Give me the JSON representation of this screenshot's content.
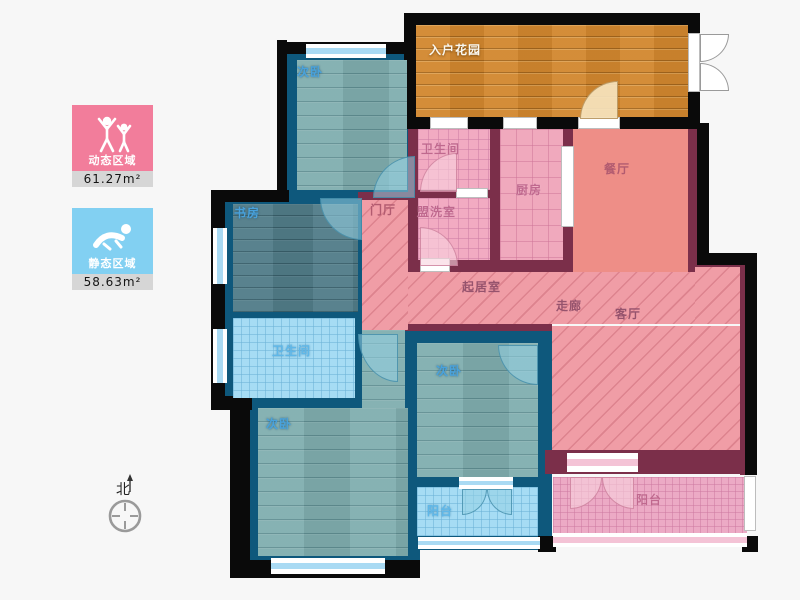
{
  "legend": {
    "dynamic": {
      "label": "动态区域",
      "value": "61.27m²",
      "color": "#f27d9b",
      "icon": "dancing-people-icon"
    },
    "static": {
      "label": "静态区域",
      "value": "58.63m²",
      "color": "#82d0f2",
      "icon": "sleeping-person-icon"
    }
  },
  "compass": {
    "label": "北"
  },
  "floorplan": {
    "palette": {
      "black": "#0a0a0a",
      "navy": "#0e587c",
      "maroon": "#7b2f4a",
      "accent_pink": "#f27d9b",
      "accent_blue": "#82d0f2"
    },
    "blocks": [
      {
        "n": "wall-bedroom-tl-block",
        "x": 279,
        "y": 44,
        "w": 139,
        "h": 156,
        "c": "navy"
      },
      {
        "n": "wall-study-band-block",
        "x": 213,
        "y": 192,
        "w": 205,
        "h": 216,
        "c": "navy"
      },
      {
        "n": "wall-bedroom-bl-block",
        "x": 248,
        "y": 398,
        "w": 172,
        "h": 178,
        "c": "navy"
      },
      {
        "n": "wall-bedroom-mid-maroon-edge",
        "x": 405,
        "y": 324,
        "w": 147,
        "h": 10,
        "c": "maroon"
      },
      {
        "n": "wall-bedroom-mid-block",
        "x": 405,
        "y": 331,
        "w": 147,
        "h": 219,
        "c": "navy"
      },
      {
        "n": "wall-pink-top-block",
        "x": 408,
        "y": 118,
        "w": 292,
        "h": 156,
        "c": "maroon"
      },
      {
        "n": "wall-foyer-top-edge",
        "x": 358,
        "y": 192,
        "w": 52,
        "h": 8,
        "c": "maroon"
      },
      {
        "n": "wall-living-bottom",
        "x": 545,
        "y": 450,
        "w": 212,
        "h": 24,
        "c": "maroon"
      },
      {
        "n": "wall-dining-right-maroon",
        "x": 688,
        "y": 125,
        "w": 9,
        "h": 139,
        "c": "maroon"
      },
      {
        "n": "wall-right-maroon",
        "x": 740,
        "y": 253,
        "w": 17,
        "h": 222,
        "c": "maroon"
      },
      {
        "n": "wall-right-step-maroon",
        "x": 695,
        "y": 260,
        "w": 62,
        "h": 10,
        "c": "maroon"
      },
      {
        "n": "wall-garden-block",
        "x": 404,
        "y": 13,
        "w": 296,
        "h": 116,
        "c": "black"
      },
      {
        "n": "wall-bedroom-tl-left-black",
        "x": 277,
        "y": 40,
        "w": 10,
        "h": 162,
        "c": "black"
      },
      {
        "n": "wall-bedroom-tl-top-black",
        "x": 277,
        "y": 42,
        "w": 141,
        "h": 12,
        "c": "black"
      },
      {
        "n": "wall-study-step-black",
        "x": 211,
        "y": 190,
        "w": 78,
        "h": 12,
        "c": "black"
      },
      {
        "n": "wall-left-black",
        "x": 211,
        "y": 190,
        "w": 14,
        "h": 216,
        "c": "black"
      },
      {
        "n": "wall-bl-step-black",
        "x": 211,
        "y": 396,
        "w": 41,
        "h": 14,
        "c": "black"
      },
      {
        "n": "wall-bedroom-bl-left-black",
        "x": 230,
        "y": 396,
        "w": 20,
        "h": 182,
        "c": "black"
      },
      {
        "n": "wall-bedroom-bl-bottom-black",
        "x": 230,
        "y": 560,
        "w": 190,
        "h": 18,
        "c": "black"
      },
      {
        "n": "wall-balcony-blue-corner-black",
        "x": 538,
        "y": 536,
        "w": 18,
        "h": 16,
        "c": "black"
      },
      {
        "n": "wall-dining-right-black",
        "x": 697,
        "y": 123,
        "w": 12,
        "h": 141,
        "c": "black"
      },
      {
        "n": "wall-right-step-black",
        "x": 697,
        "y": 253,
        "w": 60,
        "h": 12,
        "c": "black"
      },
      {
        "n": "wall-right-black",
        "x": 745,
        "y": 253,
        "w": 12,
        "h": 222,
        "c": "black"
      },
      {
        "n": "wall-balcony-pink-corner-black",
        "x": 742,
        "y": 536,
        "w": 16,
        "h": 16,
        "c": "black"
      }
    ],
    "floors": [
      {
        "n": "floor-bedroom-tl",
        "x": 297,
        "y": 60,
        "w": 110,
        "h": 130,
        "p": "teal"
      },
      {
        "n": "floor-study",
        "x": 233,
        "y": 204,
        "w": 125,
        "h": 108,
        "p": "tealdark"
      },
      {
        "n": "floor-bath-left",
        "x": 233,
        "y": 318,
        "w": 122,
        "h": 80,
        "p": "bluetile"
      },
      {
        "n": "floor-corridor",
        "x": 362,
        "y": 330,
        "w": 43,
        "h": 78,
        "p": "teal"
      },
      {
        "n": "floor-bedroom-bl",
        "x": 258,
        "y": 408,
        "w": 150,
        "h": 148,
        "p": "teal"
      },
      {
        "n": "floor-bedroom-mid",
        "x": 417,
        "y": 343,
        "w": 121,
        "h": 134,
        "p": "teal"
      },
      {
        "n": "floor-balcony-blue",
        "x": 417,
        "y": 487,
        "w": 121,
        "h": 49,
        "p": "bluetile"
      },
      {
        "n": "floor-garden",
        "x": 416,
        "y": 25,
        "w": 272,
        "h": 92,
        "p": "orange"
      },
      {
        "n": "floor-bath-top",
        "x": 418,
        "y": 129,
        "w": 72,
        "h": 61,
        "p": "cross"
      },
      {
        "n": "floor-laundry",
        "x": 418,
        "y": 198,
        "w": 72,
        "h": 62,
        "p": "cross"
      },
      {
        "n": "floor-kitchen",
        "x": 500,
        "y": 129,
        "w": 63,
        "h": 131,
        "p": "grid"
      },
      {
        "n": "floor-dining",
        "x": 573,
        "y": 129,
        "w": 115,
        "h": 143,
        "p": "salmon"
      },
      {
        "n": "floor-foyer",
        "x": 362,
        "y": 200,
        "w": 46,
        "h": 130,
        "p": "diag"
      },
      {
        "n": "floor-hall-band",
        "x": 408,
        "y": 272,
        "w": 287,
        "h": 52,
        "p": "diag"
      },
      {
        "n": "floor-hall-right-ext",
        "x": 695,
        "y": 267,
        "w": 45,
        "h": 57,
        "p": "diag"
      },
      {
        "n": "floor-living-main",
        "x": 552,
        "y": 326,
        "w": 188,
        "h": 124,
        "p": "diag"
      },
      {
        "n": "floor-balcony-pink",
        "x": 553,
        "y": 477,
        "w": 194,
        "h": 56,
        "p": "pinktile"
      }
    ],
    "windows": [
      {
        "n": "window-bedroom-tl-top",
        "x": 306,
        "y": 44,
        "w": 80,
        "h": 14,
        "t": "blue"
      },
      {
        "n": "window-study-left",
        "x": 213,
        "y": 228,
        "w": 14,
        "h": 56,
        "t": "blue"
      },
      {
        "n": "window-bath-left",
        "x": 213,
        "y": 329,
        "w": 14,
        "h": 54,
        "t": "blue"
      },
      {
        "n": "window-bedroom-bl-bottom",
        "x": 271,
        "y": 558,
        "w": 114,
        "h": 16,
        "t": "blue"
      },
      {
        "n": "window-balcony-blue-bottom",
        "x": 418,
        "y": 537,
        "w": 122,
        "h": 12,
        "t": "blue"
      },
      {
        "n": "window-bedroom-mid-sill",
        "x": 459,
        "y": 477,
        "w": 54,
        "h": 12,
        "t": "blue"
      },
      {
        "n": "window-garden-bath",
        "x": 430,
        "y": 117,
        "w": 38,
        "h": 12,
        "t": "plain"
      },
      {
        "n": "window-garden-kitchen",
        "x": 503,
        "y": 117,
        "w": 34,
        "h": 12,
        "t": "plain"
      },
      {
        "n": "door-gap-garden",
        "x": 578,
        "y": 117,
        "w": 42,
        "h": 12,
        "t": "plain"
      },
      {
        "n": "door-gap-garden-entry",
        "x": 688,
        "y": 33,
        "w": 12,
        "h": 59,
        "t": "plain"
      },
      {
        "n": "door-sliding-kitchen",
        "x": 561,
        "y": 146,
        "w": 13,
        "h": 81,
        "t": "plain"
      },
      {
        "n": "door-gap-bath-top",
        "x": 456,
        "y": 188,
        "w": 32,
        "h": 10,
        "t": "plain"
      },
      {
        "n": "door-gap-laundry",
        "x": 420,
        "y": 258,
        "w": 30,
        "h": 14,
        "t": "plain"
      },
      {
        "n": "window-balcony-pink-right",
        "x": 744,
        "y": 476,
        "w": 12,
        "h": 55,
        "t": "plain"
      },
      {
        "n": "window-balcony-pink-bottom",
        "x": 553,
        "y": 533,
        "w": 194,
        "h": 14,
        "t": "pink"
      },
      {
        "n": "door-sill-living-balcony",
        "x": 567,
        "y": 453,
        "w": 71,
        "h": 19,
        "t": "pink"
      }
    ],
    "doors": [
      {
        "n": "door-arc-bedroom-tl",
        "x": 373,
        "y": 156,
        "w": 42,
        "h": 42,
        "r": "tl",
        "t": "blue"
      },
      {
        "n": "door-arc-study",
        "x": 320,
        "y": 198,
        "w": 42,
        "h": 42,
        "r": "bl",
        "t": "blue"
      },
      {
        "n": "door-arc-bath-top",
        "x": 420,
        "y": 153,
        "w": 37,
        "h": 39,
        "r": "tl",
        "t": "pink"
      },
      {
        "n": "door-arc-laundry",
        "x": 420,
        "y": 227,
        "w": 38,
        "h": 39,
        "r": "tr",
        "t": "pink"
      },
      {
        "n": "door-arc-garden",
        "x": 580,
        "y": 81,
        "w": 38,
        "h": 38,
        "r": "tl",
        "t": "beige"
      },
      {
        "n": "door-leaf-entry-upper",
        "x": 700,
        "y": 34,
        "w": 29,
        "h": 28,
        "r": "br",
        "t": "white"
      },
      {
        "n": "door-leaf-entry-lower",
        "x": 700,
        "y": 63,
        "w": 29,
        "h": 28,
        "r": "tr",
        "t": "white"
      },
      {
        "n": "door-arc-bath-left",
        "x": 358,
        "y": 334,
        "w": 40,
        "h": 48,
        "r": "bl",
        "t": "blue"
      },
      {
        "n": "door-arc-bedroom-mid",
        "x": 498,
        "y": 345,
        "w": 40,
        "h": 40,
        "r": "bl",
        "t": "blue"
      },
      {
        "n": "door-leaf-balcony-blue-l",
        "x": 462,
        "y": 489,
        "w": 25,
        "h": 26,
        "r": "br",
        "t": "blue"
      },
      {
        "n": "door-leaf-balcony-blue-r",
        "x": 487,
        "y": 489,
        "w": 25,
        "h": 26,
        "r": "bl",
        "t": "blue"
      },
      {
        "n": "door-leaf-balcony-pink-l",
        "x": 570,
        "y": 477,
        "w": 32,
        "h": 32,
        "r": "br",
        "t": "pink"
      },
      {
        "n": "door-leaf-balcony-pink-r",
        "x": 602,
        "y": 477,
        "w": 32,
        "h": 32,
        "r": "bl",
        "t": "pink"
      }
    ],
    "labels": [
      {
        "n": "label-bedroom-tl",
        "text": "次卧",
        "x": 297,
        "y": 66,
        "t": "blue"
      },
      {
        "n": "label-garden",
        "text": "入户花园",
        "x": 429,
        "y": 44,
        "t": "white"
      },
      {
        "n": "label-bath-top",
        "text": "卫生间",
        "x": 421,
        "y": 143,
        "t": "pink"
      },
      {
        "n": "label-kitchen",
        "text": "厨房",
        "x": 516,
        "y": 184,
        "t": "pink"
      },
      {
        "n": "label-dining",
        "text": "餐厅",
        "x": 604,
        "y": 163,
        "t": "pinkdark"
      },
      {
        "n": "label-foyer",
        "text": "门厅",
        "x": 370,
        "y": 204,
        "t": "pinkdark"
      },
      {
        "n": "label-laundry",
        "text": "盟洗室",
        "x": 417,
        "y": 206,
        "t": "pink"
      },
      {
        "n": "label-study",
        "text": "书房",
        "x": 234,
        "y": 207,
        "t": "blue"
      },
      {
        "n": "label-bath-left",
        "text": "卫生间",
        "x": 272,
        "y": 345,
        "t": "bluelight"
      },
      {
        "n": "label-bedroom-bl",
        "text": "次卧",
        "x": 266,
        "y": 418,
        "t": "blue"
      },
      {
        "n": "label-bedroom-mid",
        "text": "次卧",
        "x": 436,
        "y": 365,
        "t": "blue"
      },
      {
        "n": "label-balcony-blue",
        "text": "阳台",
        "x": 427,
        "y": 505,
        "t": "bluelight"
      },
      {
        "n": "label-living-room",
        "text": "起居室",
        "x": 462,
        "y": 281,
        "t": "hall"
      },
      {
        "n": "label-corridor",
        "text": "走廊",
        "x": 556,
        "y": 300,
        "t": "hall"
      },
      {
        "n": "label-parlor",
        "text": "客厅",
        "x": 615,
        "y": 308,
        "t": "hall"
      },
      {
        "n": "label-balcony-pink",
        "text": "阳台",
        "x": 636,
        "y": 494,
        "t": "pink"
      }
    ]
  }
}
